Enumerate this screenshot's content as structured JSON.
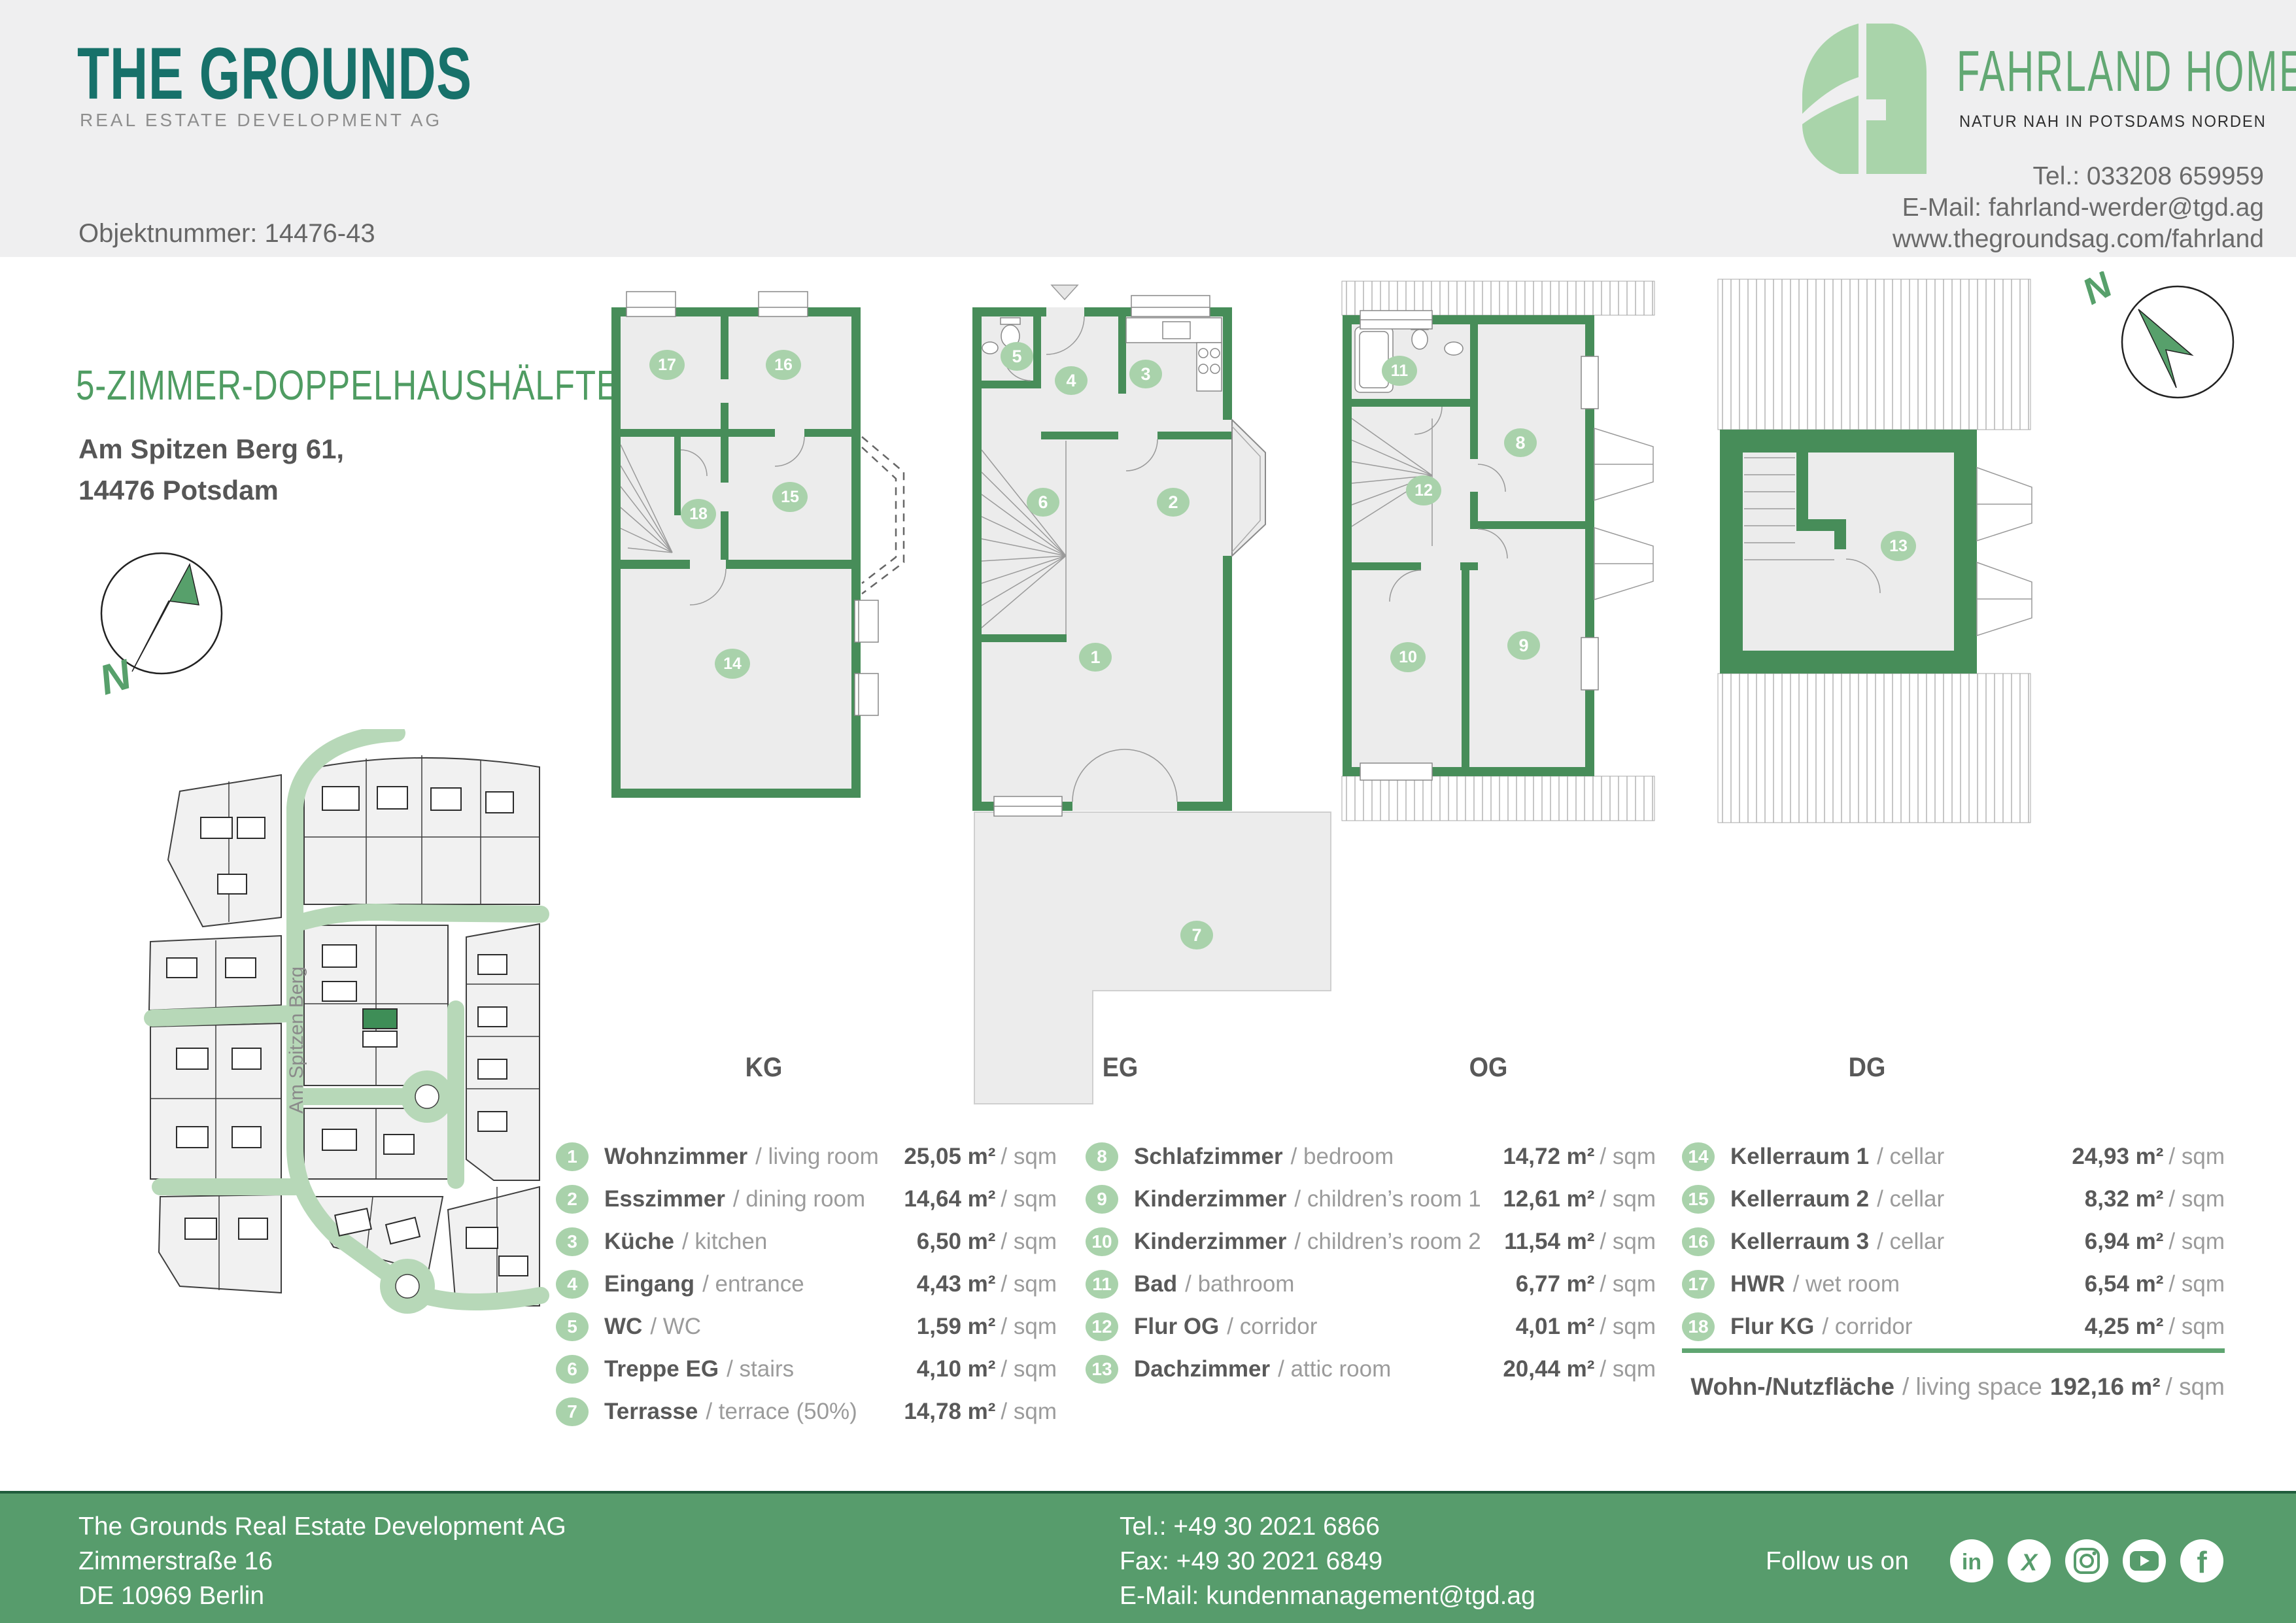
{
  "header": {
    "brand_title": "THE GROUNDS",
    "brand_subtitle": "REAL ESTATE DEVELOPMENT AG",
    "object_number": "Objektnummer: 14476-43",
    "partner_name": "FAHRLAND HOMES",
    "partner_tagline": "NATUR NAH IN POTSDAMS NORDEN",
    "contact_tel": "Tel.: 033208 659959",
    "contact_email": "E-Mail: fahrland-werder@tgd.ag",
    "contact_web": "www.thegroundsag.com/fahrland"
  },
  "property": {
    "title": "5-ZIMMER-DOPPELHAUSHÄLFTE",
    "address1": "Am Spitzen Berg 61,",
    "address2": "14476 Potsdam",
    "street_label": "Am Spitzen Berg",
    "compass": "N"
  },
  "floors": {
    "kg": "KG",
    "eg": "EG",
    "og": "OG",
    "dg": "DG"
  },
  "plan_badges": {
    "kg": [
      "17",
      "16",
      "15",
      "18",
      "14"
    ],
    "eg": [
      "5",
      "4",
      "3",
      "6",
      "2",
      "1",
      "7"
    ],
    "og": [
      "11",
      "8",
      "12",
      "10",
      "9"
    ],
    "dg": [
      "13"
    ]
  },
  "rooms": [
    {
      "num": "1",
      "de": "Wohnzimmer",
      "en": "/ living room",
      "area": "25,05 m²",
      "per": "/ sqm"
    },
    {
      "num": "2",
      "de": "Esszimmer",
      "en": "/ dining room",
      "area": "14,64 m²",
      "per": "/ sqm"
    },
    {
      "num": "3",
      "de": "Küche",
      "en": "/ kitchen",
      "area": "6,50 m²",
      "per": "/ sqm"
    },
    {
      "num": "4",
      "de": "Eingang",
      "en": "/ entrance",
      "area": "4,43 m²",
      "per": "/ sqm"
    },
    {
      "num": "5",
      "de": "WC",
      "en": "/ WC",
      "area": "1,59 m²",
      "per": "/ sqm"
    },
    {
      "num": "6",
      "de": "Treppe EG",
      "en": "/ stairs",
      "area": "4,10 m²",
      "per": "/ sqm"
    },
    {
      "num": "7",
      "de": "Terrasse",
      "en": "/ terrace (50%)",
      "area": "14,78 m²",
      "per": "/ sqm"
    },
    {
      "num": "8",
      "de": "Schlafzimmer",
      "en": "/ bedroom",
      "area": "14,72 m²",
      "per": "/ sqm"
    },
    {
      "num": "9",
      "de": "Kinderzimmer",
      "en": "/ children’s room 1",
      "area": "12,61 m²",
      "per": "/ sqm"
    },
    {
      "num": "10",
      "de": "Kinderzimmer",
      "en": "/ children’s room 2",
      "area": "11,54 m²",
      "per": "/ sqm"
    },
    {
      "num": "11",
      "de": "Bad",
      "en": "/ bathroom",
      "area": "6,77 m²",
      "per": "/ sqm"
    },
    {
      "num": "12",
      "de": "Flur OG",
      "en": "/ corridor",
      "area": "4,01 m²",
      "per": "/ sqm"
    },
    {
      "num": "13",
      "de": "Dachzimmer",
      "en": "/ attic room",
      "area": "20,44 m²",
      "per": "/ sqm"
    },
    {
      "num": "14",
      "de": "Kellerraum 1",
      "en": "/ cellar",
      "area": "24,93 m²",
      "per": "/ sqm"
    },
    {
      "num": "15",
      "de": "Kellerraum 2",
      "en": "/ cellar",
      "area": "8,32 m²",
      "per": "/ sqm"
    },
    {
      "num": "16",
      "de": "Kellerraum 3",
      "en": "/ cellar",
      "area": "6,94 m²",
      "per": "/ sqm"
    },
    {
      "num": "17",
      "de": "HWR",
      "en": "/ wet room",
      "area": "6,54 m²",
      "per": "/ sqm"
    },
    {
      "num": "18",
      "de": "Flur KG",
      "en": "/ corridor",
      "area": "4,25 m²",
      "per": "/ sqm"
    }
  ],
  "total": {
    "de": "Wohn-/Nutzfläche",
    "en": "/ living space",
    "area": "192,16 m²",
    "per": "/ sqm"
  },
  "footer": {
    "company": [
      "The Grounds Real Estate Development AG",
      "Zimmerstraße 16",
      "DE 10969 Berlin"
    ],
    "contact": [
      "Tel.: +49 30 2021 6866",
      "Fax: +49 30 2021 6849",
      "E-Mail: kundenmanagement@tgd.ag"
    ],
    "follow": "Follow us on",
    "social": [
      "linkedin",
      "xing",
      "instagram",
      "youtube",
      "facebook"
    ]
  },
  "colors": {
    "brand_teal": "#17716a",
    "accent_green": "#4f9c62",
    "wall_green": "#478d59",
    "badge_green": "#a9d2ab",
    "footer_green": "#579c6c",
    "logo_light_green": "#a9d4aa"
  }
}
